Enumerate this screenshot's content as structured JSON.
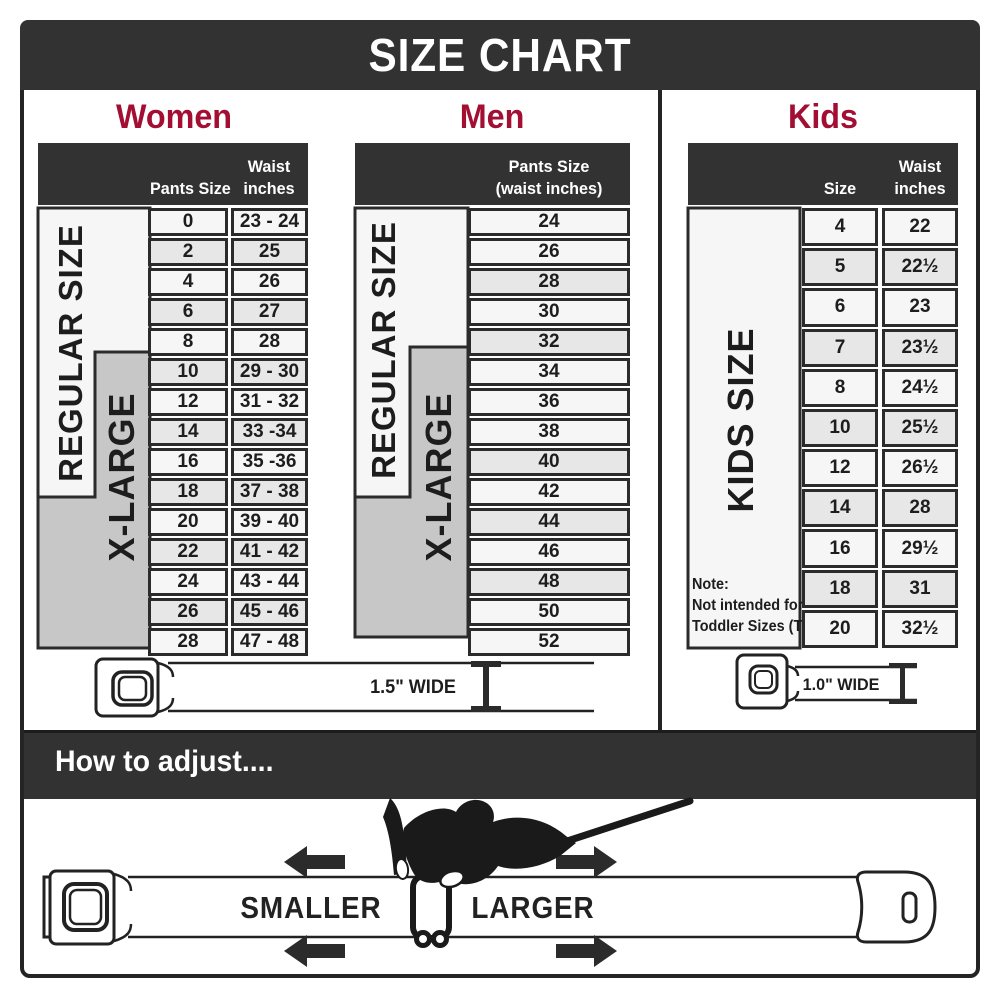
{
  "banner": {
    "title": "SIZE CHART"
  },
  "colors": {
    "accent": "#a30e33",
    "dark": "#323232",
    "row_light": "#f6f6f6",
    "row_alt": "#e7e7e7",
    "zone_gray": "#c7c7c7"
  },
  "sections": {
    "women": {
      "title": "Women",
      "col1_header": "Pants Size",
      "col2_header_line1": "Waist",
      "col2_header_line2": "inches",
      "regular_label": "REGULAR SIZE",
      "xlarge_label": "X-LARGE",
      "rows": [
        {
          "size": "0",
          "waist": "23 - 24"
        },
        {
          "size": "2",
          "waist": "25"
        },
        {
          "size": "4",
          "waist": "26"
        },
        {
          "size": "6",
          "waist": "27"
        },
        {
          "size": "8",
          "waist": "28"
        },
        {
          "size": "10",
          "waist": "29 - 30"
        },
        {
          "size": "12",
          "waist": "31 - 32"
        },
        {
          "size": "14",
          "waist": "33 -34"
        },
        {
          "size": "16",
          "waist": "35 -36"
        },
        {
          "size": "18",
          "waist": "37 - 38"
        },
        {
          "size": "20",
          "waist": "39 - 40"
        },
        {
          "size": "22",
          "waist": "41 - 42"
        },
        {
          "size": "24",
          "waist": "43 - 44"
        },
        {
          "size": "26",
          "waist": "45 - 46"
        },
        {
          "size": "28",
          "waist": "47 - 48"
        }
      ],
      "alt_rows": [
        1,
        3,
        5,
        7,
        9,
        11,
        13
      ]
    },
    "men": {
      "title": "Men",
      "col_header_line1": "Pants Size",
      "col_header_line2": "(waist inches)",
      "regular_label": "REGULAR SIZE",
      "xlarge_label": "X-LARGE",
      "rows": [
        "24",
        "26",
        "28",
        "30",
        "32",
        "34",
        "36",
        "38",
        "40",
        "42",
        "44",
        "46",
        "48",
        "50",
        "52"
      ],
      "alt_rows": [
        2,
        4,
        8,
        10,
        12
      ]
    },
    "kids": {
      "title": "Kids",
      "col1_header": "Size",
      "col2_header_line1": "Waist",
      "col2_header_line2": "inches",
      "kids_label": "KIDS SIZE",
      "note_line1": "Note:",
      "note_line2": "Not intended for",
      "note_line3": "Toddler Sizes (T)",
      "rows": [
        {
          "size": "4",
          "waist": "22"
        },
        {
          "size": "5",
          "waist": "22½"
        },
        {
          "size": "6",
          "waist": "23"
        },
        {
          "size": "7",
          "waist": "23½"
        },
        {
          "size": "8",
          "waist": "24½"
        },
        {
          "size": "10",
          "waist": "25½"
        },
        {
          "size": "12",
          "waist": "26½"
        },
        {
          "size": "14",
          "waist": "28"
        },
        {
          "size": "16",
          "waist": "29½"
        },
        {
          "size": "18",
          "waist": "31"
        },
        {
          "size": "20",
          "waist": "32½"
        }
      ],
      "alt_rows": [
        1,
        3,
        5,
        7,
        9
      ]
    }
  },
  "belts": {
    "adult_width_label": "1.5\" WIDE",
    "kids_width_label": "1.0\" WIDE"
  },
  "adjust": {
    "title": "How to adjust....",
    "smaller_label": "SMALLER",
    "larger_label": "LARGER"
  }
}
